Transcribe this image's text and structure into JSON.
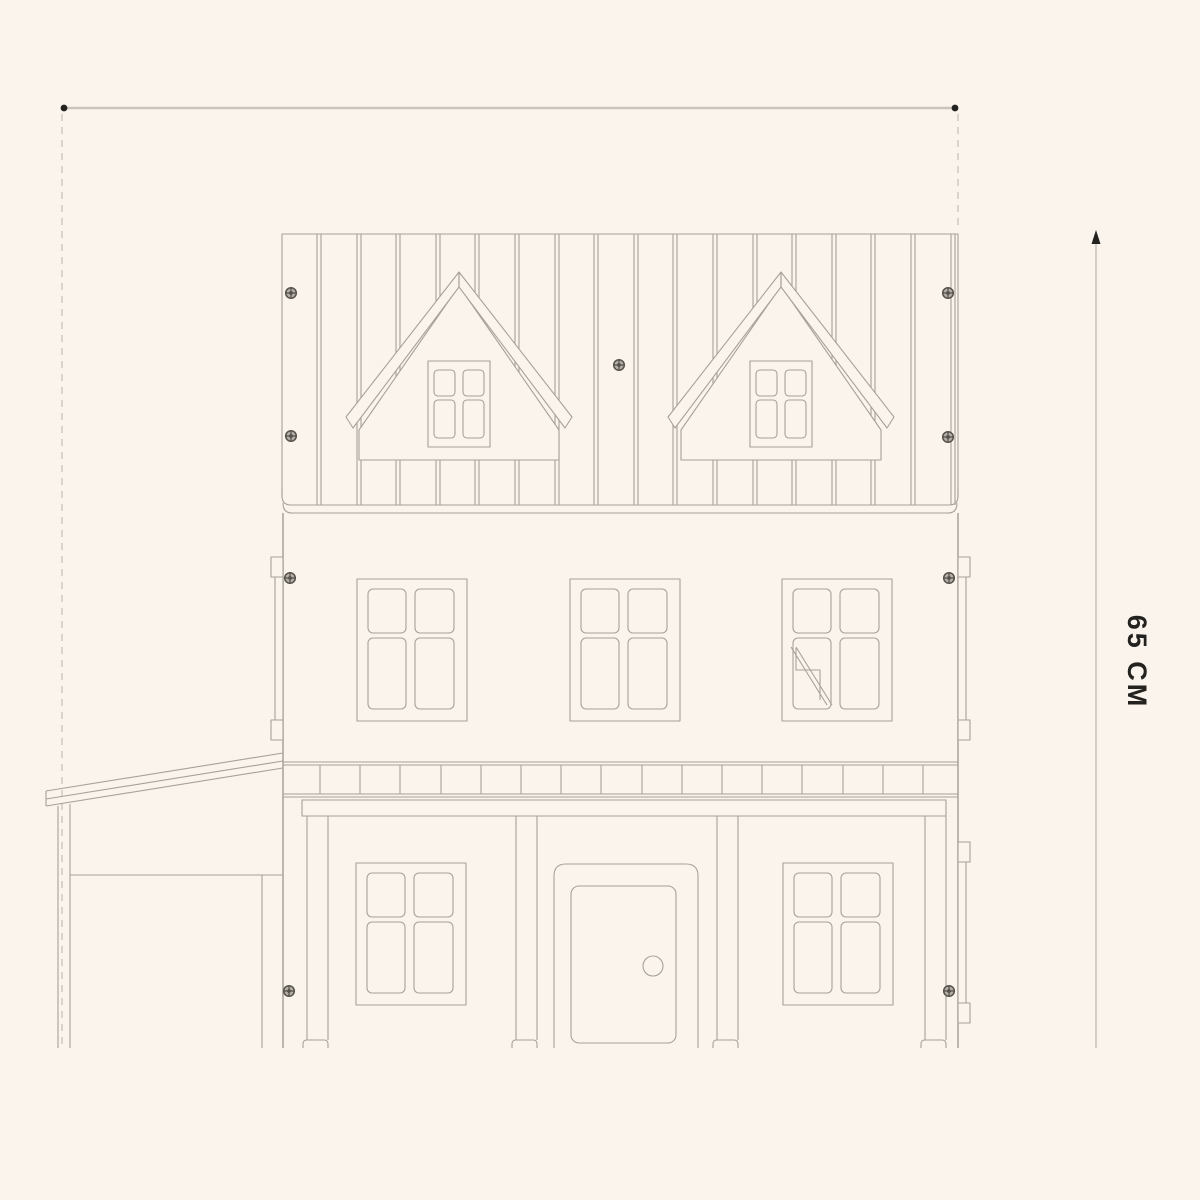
{
  "colors": {
    "background": "#FAF4EC",
    "line": "#A8A198",
    "dim_line": "#C9C4BC",
    "dim_dash": "#C3BEB6",
    "ink": "#23221E",
    "screw_fill": "#B5AFA7",
    "screw_ring": "#55524B"
  },
  "dimension": {
    "height_label": "65 CM"
  }
}
